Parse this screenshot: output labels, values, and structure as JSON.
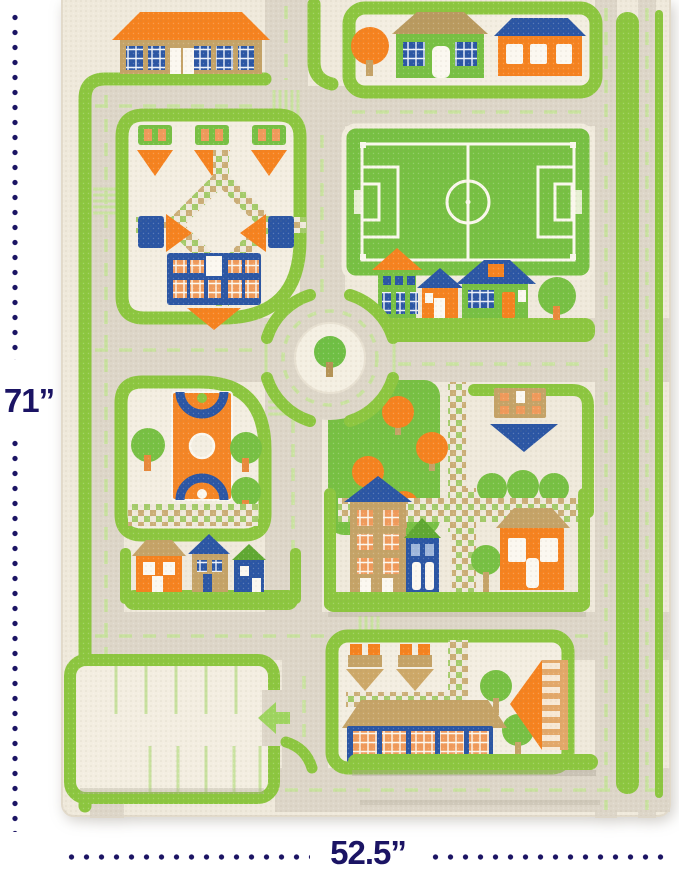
{
  "annotations": {
    "height_label": "71”",
    "width_label": "52.5”"
  },
  "palette": {
    "label_navy": "#1B1464",
    "rug_cream": "#EFE9DB",
    "block_cream": "#F3EEE1",
    "road": "#DDD6C8",
    "lane": "#C9E2A0",
    "grass_green": "#8CC63F",
    "field_green": "#77C043",
    "accent_orange": "#F5821F",
    "orange_light": "#F09A5B",
    "accent_blue": "#2B56A4",
    "tan": "#C5A367",
    "white_soft": "#FBF8F0",
    "shadow_gray": "#AFA899"
  },
  "rug_features": [
    "school-building",
    "residential-houses",
    "garden-park",
    "soccer-field",
    "roundabout",
    "town-center-houses",
    "basketball-court",
    "orchard-park",
    "apartment-buildings",
    "village-houses",
    "parking-lot",
    "market-street",
    "road-network"
  ]
}
